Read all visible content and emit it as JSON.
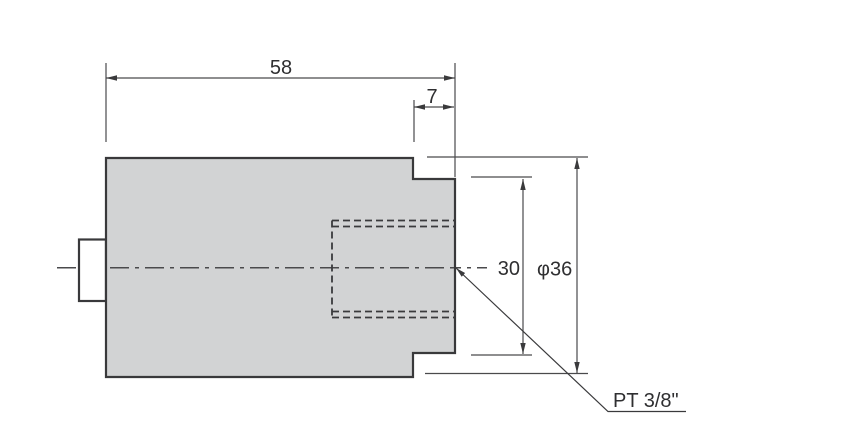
{
  "diagram": {
    "kind": "engineering-dimension-drawing",
    "dimensions": {
      "overall_length": "58",
      "right_step_length": "7",
      "step_diameter": "30",
      "body_diameter": "φ36",
      "port_thread": "PT 3/8\""
    },
    "colors": {
      "background": "#ffffff",
      "body_fill": "#d2d3d4",
      "outline": "#39393b",
      "dim_line": "#4a4a4c",
      "text": "#2f2f31"
    }
  }
}
